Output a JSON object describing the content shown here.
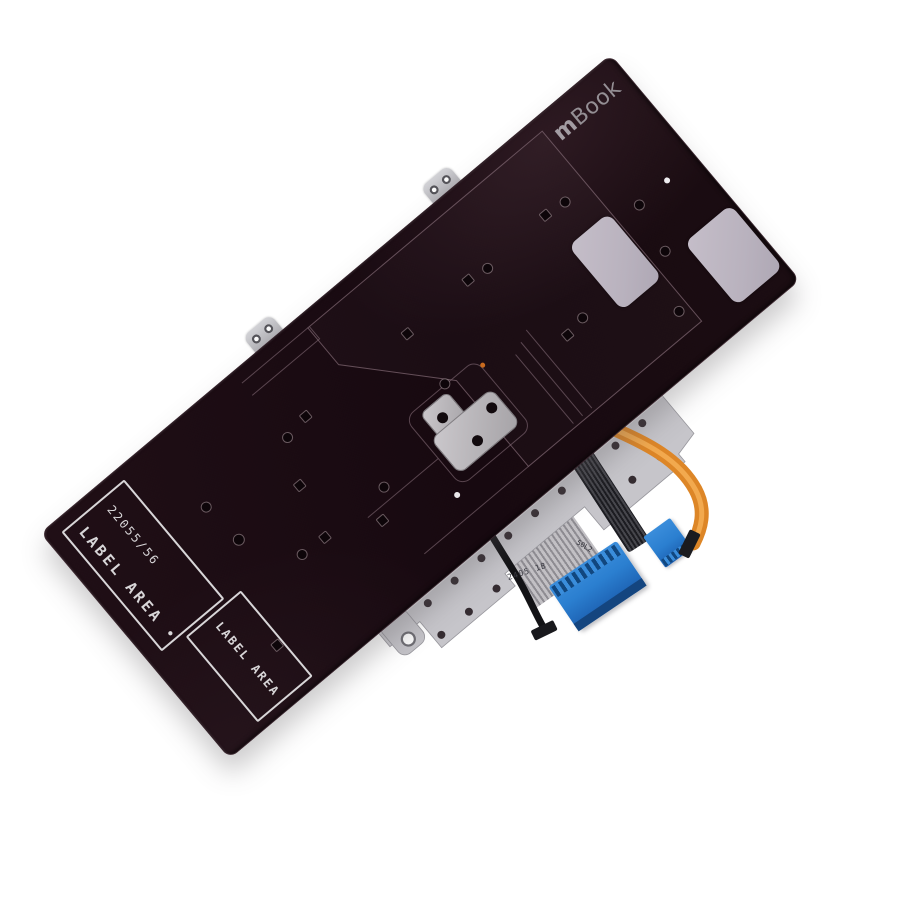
{
  "product": {
    "brand_prefix": "m",
    "brand_suffix": "Book",
    "part_number": "22055/56",
    "label_area_primary": "LABEL AREA",
    "label_separator_dot": "•",
    "label_area_secondary": "LABEL AREA",
    "cable_marking_primary": "2405 1B",
    "cable_marking_secondary": "50L2"
  },
  "colors": {
    "background": "#ffffff",
    "plate": "#1b0d12",
    "plate_sheen": "#2c181e",
    "etch_line": "#7d6570",
    "label_outline": "#d8d6d8",
    "brand_text": "#948f94",
    "sticker_pad": "#b9b2be",
    "metal_silver": "#c6c5ca",
    "metal_edge": "#97969c",
    "rivet": "#352c31",
    "ribbon_gray": "#c2c0c4",
    "ribbon_stripe": "#8e8c92",
    "connector_blue": "#2b7fd0",
    "connector_blue_dark": "#11477f",
    "cable_orange": "#dd8627",
    "cable_orange_light": "#f2a94e",
    "cable_dark": "#232328",
    "hole_fill": "#0d0509"
  }
}
